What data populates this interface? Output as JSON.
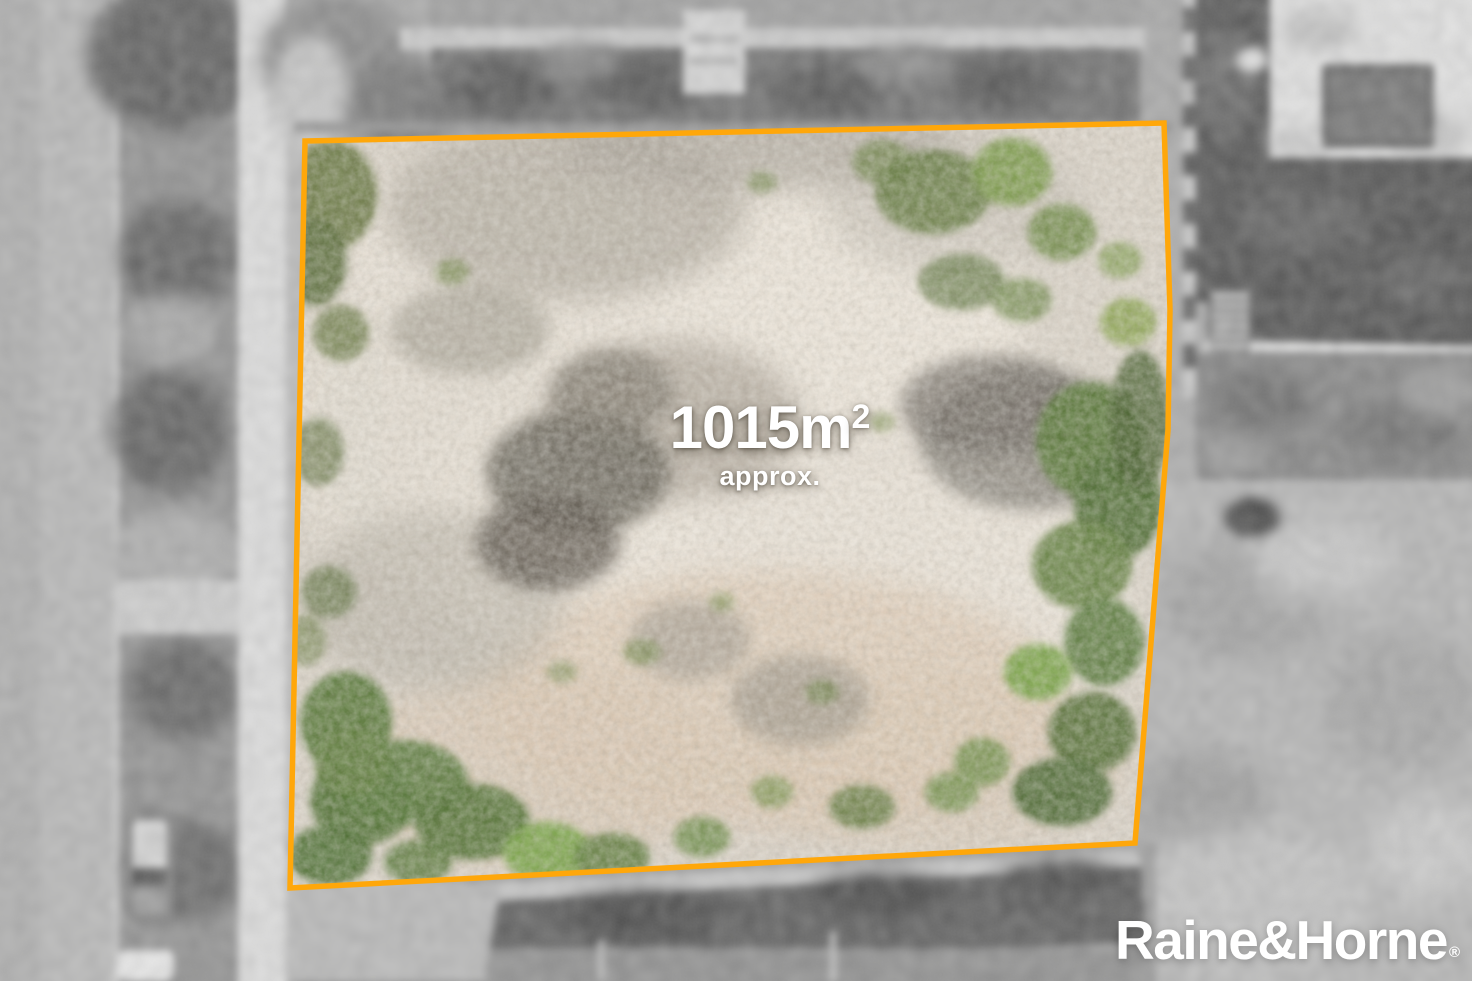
{
  "overlay": {
    "area_value": "1015m",
    "area_superscript": "2",
    "area_qualifier": "approx."
  },
  "watermark": {
    "brand": "Raine&Horne",
    "registered_mark": "®"
  },
  "colors": {
    "boundary_outline": "#FFA70A",
    "overlay_text": "#FFFFFF",
    "watermark_text": "#FFFFFF",
    "lot_ground": "#D8D1C6",
    "vegetation": "#5D7A3C"
  }
}
